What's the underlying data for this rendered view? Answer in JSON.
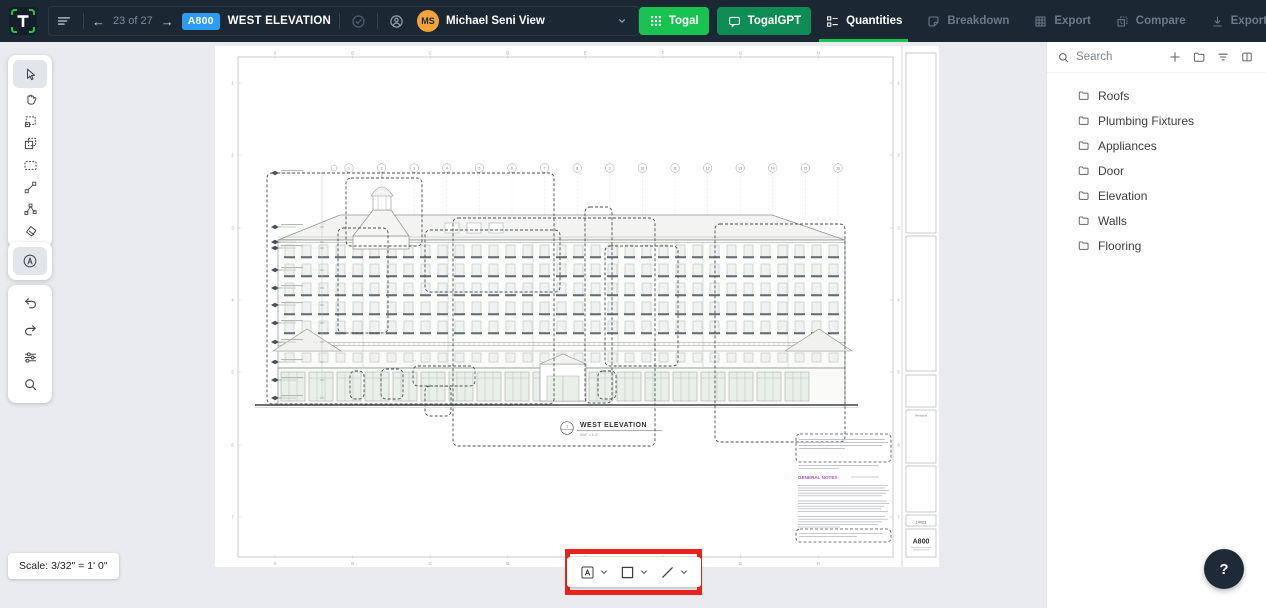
{
  "top_bar": {
    "logo_letter": "T",
    "page_nav": {
      "prev": "←",
      "current_label": "23 of 27",
      "next": "→"
    },
    "sheet_badge": "A800",
    "sheet_title": "WEST ELEVATION",
    "user_view": {
      "avatar_initials": "MS",
      "label": "Michael Seni View"
    },
    "actions": {
      "togal": "Togal",
      "togalgpt": "TogalGPT"
    },
    "tabs": [
      {
        "label": "Quantities",
        "active": true
      },
      {
        "label": "Breakdown",
        "active": false
      },
      {
        "label": "Export",
        "active": false
      },
      {
        "label": "Compare",
        "active": false
      },
      {
        "label": "Export PDF",
        "active": false
      }
    ],
    "colors": {
      "bar_bg": "#1B2733",
      "togal_green": "#18C351",
      "togalgpt_green": "#0D8C55",
      "badge_blue": "#2D9CF4",
      "avatar_orange": "#F2A33C",
      "active_tab_underline": "#18C351"
    }
  },
  "sheet": {
    "grid_letters": [
      "A",
      "B",
      "C",
      "D",
      "E",
      "F",
      "G",
      "H"
    ],
    "grid_numbers": [
      "1",
      "2",
      "3",
      "4",
      "5",
      "6",
      "7"
    ],
    "column_bubbles": [
      "1",
      "2",
      "3",
      "4",
      "5",
      "6",
      "7",
      "8",
      "9",
      "10",
      "11",
      "12",
      "13",
      "14",
      "15",
      "16"
    ],
    "view_number": "1",
    "view_title": "WEST ELEVATION",
    "view_scale": "3/32\" = 1'-0\"",
    "notes_header": "GENERAL NOTES",
    "title_block": {
      "revisions_label": "Revisions",
      "project_number": "14023",
      "sheet_number": "A800"
    }
  },
  "sidebar": {
    "search_placeholder": "Search",
    "folders": [
      {
        "label": "Roofs"
      },
      {
        "label": "Plumbing Fixtures"
      },
      {
        "label": "Appliances"
      },
      {
        "label": "Door"
      },
      {
        "label": "Elevation"
      },
      {
        "label": "Walls"
      },
      {
        "label": "Flooring"
      }
    ]
  },
  "bottom": {
    "scale_label": "Scale: 3/32\" = 1' 0\"",
    "help_label": "?"
  },
  "annotation": {
    "color": "#E8231F"
  }
}
